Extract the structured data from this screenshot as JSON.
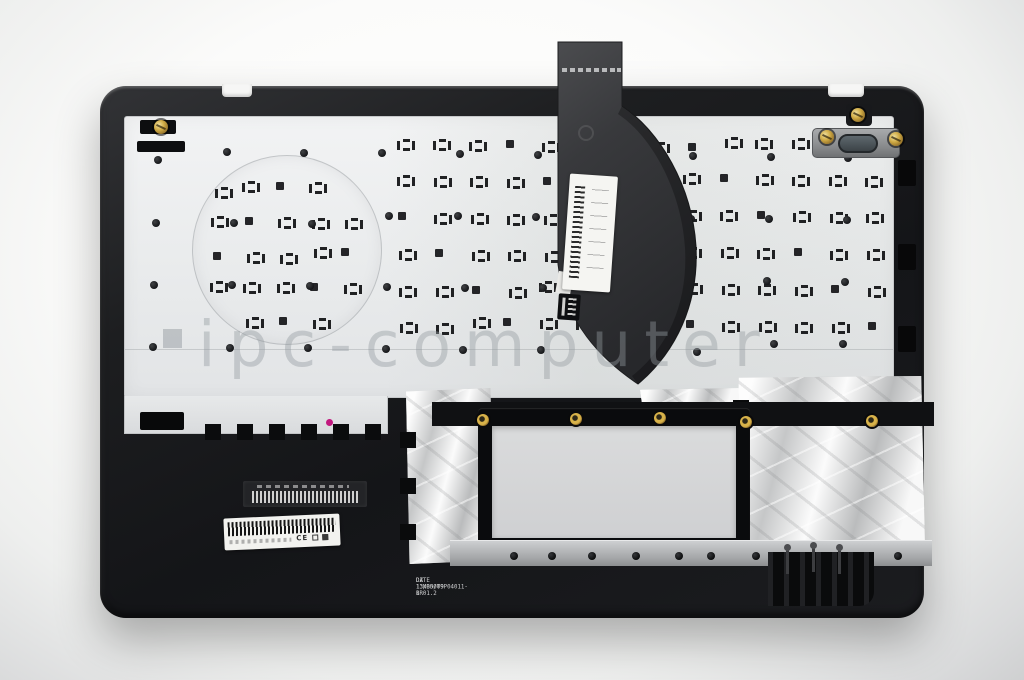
{
  "watermark": {
    "text": "ipc-computer"
  },
  "markings": {
    "part_line": "DZ 13NB00T9P04011-1R",
    "date_line": "DATE 13/05/09 B 01.2"
  },
  "labels": {
    "ce_mark": "CE"
  },
  "colors": {
    "background": "#f4f4f3",
    "case_black": "#17181a",
    "plate_silver": "#eceeef",
    "cable_gray": "#3a3b3e",
    "foil_silver": "#d8d9d9",
    "touchpad_aperture_gray": "#d3d4d6",
    "brass_gold": "#d0ab45",
    "watermark_gray": "#969ca2",
    "magenta_dot": "#c2187e"
  }
}
